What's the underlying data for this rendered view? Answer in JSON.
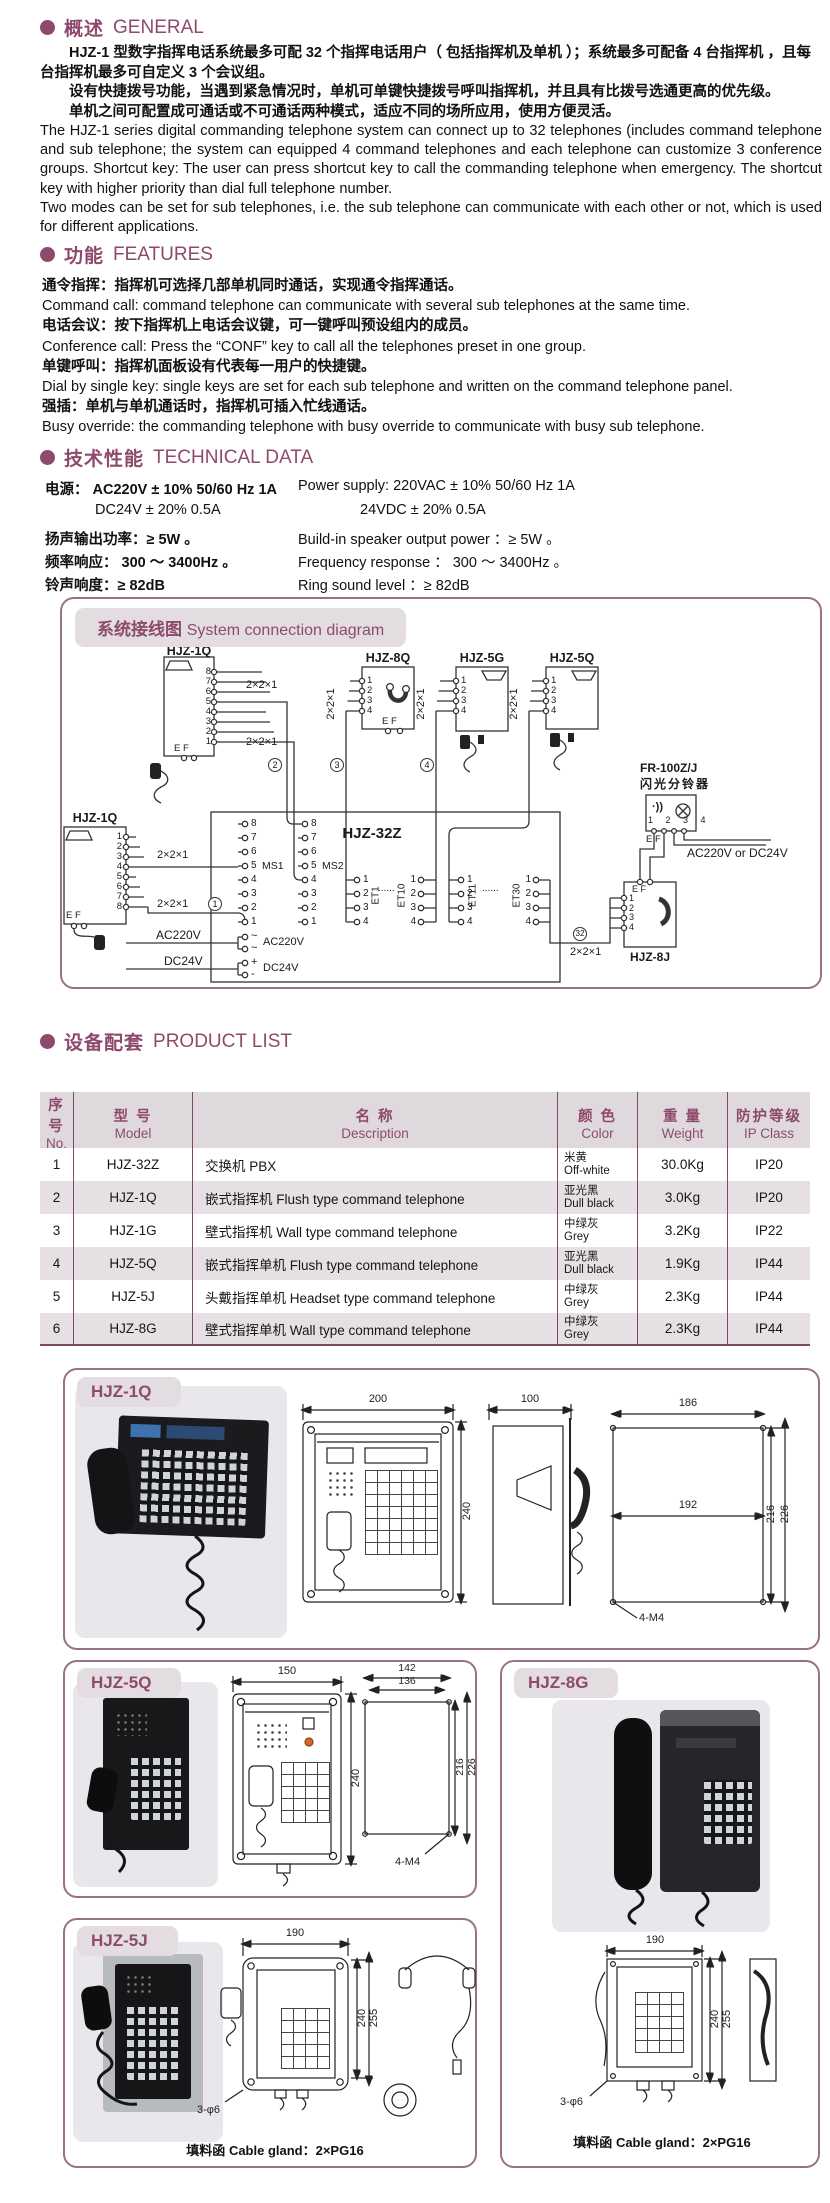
{
  "colors": {
    "accent": "#8e4a6c",
    "table_line": "#7b4a66",
    "chip_bg": "#e3dde1",
    "row_alt": "#e6e0e4",
    "led_orange": "#d06a28"
  },
  "general": {
    "title_cn": "概述",
    "title_en": "GENERAL",
    "cn": [
      "HJZ-1 型数字指挥电话系统最多可配 32 个指挥电话用户（ 包括指挥机及单机 ）；系统最多可配备 4 台指挥机 ，且每台指挥机最多可自定义 3 个会议组。",
      "设有快捷拨号功能，当遇到紧急情况时，单机可单键快捷拨号呼叫指挥机，并且具有比拨号选通更高的优先级。",
      "单机之间可配置成可通话或不可通话两种模式，适应不同的场所应用，使用方便灵活。"
    ],
    "en": "The HJZ-1 series digital commanding telephone system can connect up to 32 telephones (includes command telephone and sub telephone; the system can equipped 4 command telephones and each telephone can customize 3 conference groups. Shortcut key: The user can press shortcut key to call the commanding telephone when emergency. The shortcut key with higher priority than dial full telephone number.\nTwo modes can be set for sub telephones, i.e. the sub telephone can communicate with each other or not, which is used for different applications."
  },
  "features": {
    "title_cn": "功能",
    "title_en": "FEATURES",
    "items": [
      {
        "cn": "通令指挥：指挥机可选择几部单机同时通话，实现通令指挥通话。",
        "en": "Command call: command telephone can communicate with  several sub telephones at the same time."
      },
      {
        "cn": "电话会议：按下指挥机上电话会议键，可一键呼叫预设组内的成员。",
        "en": "Conference call:  Press  the “CONF” key to call all the telephones preset in one group."
      },
      {
        "cn": "单键呼叫：指挥机面板设有代表每一用户的快捷键。",
        "en": "Dial  by single key:  single  keys are set for each sub telephone and written on the command telephone panel."
      },
      {
        "cn": "强插：单机与单机通话时，指挥机可插入忙线通话。",
        "en": "Busy  override:  the commanding telephone with busy override to communicate with busy sub telephone."
      }
    ]
  },
  "technical": {
    "title_cn": "技术性能",
    "title_en": "TECHNICAL  DATA",
    "left": [
      "电源：  AC220V ± 10% 50/60 Hz 1A",
      "DC24V ± 20%    0.5A",
      "扬声输出功率：≥ 5W 。",
      "频率响应：  300 ～ 3400Hz 。",
      "铃声响度：≥ 82dB"
    ],
    "right": [
      "Power supply: 220VAC ± 10% 50/60 Hz 1A",
      "24VDC ± 20%    0.5A",
      "Build-in speaker output power ：≥ 5W 。",
      "Frequency response ：  300 ～ 3400Hz 。",
      "Ring sound level ：≥ 82dB"
    ]
  },
  "diagram": {
    "title_cn": "系统接线图",
    "title_en": "System connection diagram",
    "d_hjz1q": "HJZ-1Q",
    "d_hjz8q": "HJZ-8Q",
    "d_hjz5g": "HJZ-5G",
    "d_hjz5q": "HJZ-5Q",
    "d_hjz32z": "HJZ-32Z",
    "d_hjz8j": "HJZ-8J",
    "d_fr": "FR-100Z/J",
    "d_fr_cn": "闪光分铃器",
    "wire": "2×2×1",
    "ms1": "MS1",
    "ms2": "MS2",
    "et1": "ET1",
    "et10": "ET10",
    "et11": "ET11",
    "et30": "ET30",
    "dots": "......",
    "ac": "AC220V",
    "dc": "DC24V",
    "acdc": "AC220V\nor DC24V",
    "ef": "E F",
    "ef2": "E  F",
    "p81": "8\n7\n6\n5\n4\n3\n2\n1",
    "p18": "1\n2\n3\n4\n5\n6\n7\n8",
    "p14": "1\n2\n3\n4",
    "p14h": "1 2 3 4",
    "tilde": "~\n~",
    "pm": "+\n-",
    "c1": "1",
    "c2": "2",
    "c3": "3",
    "c4": "4",
    "c32": "32"
  },
  "product_list": {
    "title_cn": "设备配套",
    "title_en": "PRODUCT LIST",
    "headers": [
      {
        "cn": "序号",
        "en": "No."
      },
      {
        "cn": "型 号",
        "en": "Model"
      },
      {
        "cn": "名  称",
        "en": "Description"
      },
      {
        "cn": "颜 色",
        "en": "Color"
      },
      {
        "cn": "重 量",
        "en": "Weight"
      },
      {
        "cn": "防护等级",
        "en": "IP Class"
      }
    ],
    "rows": [
      {
        "no": "1",
        "model": "HJZ-32Z",
        "desc": "交换机  PBX",
        "color_cn": "米黄",
        "color_en": "Off-white",
        "weight": "30.0Kg",
        "ip": "IP20"
      },
      {
        "no": "2",
        "model": "HJZ-1Q",
        "desc": "嵌式指挥机  Flush type command telephone",
        "color_cn": "亚光黑",
        "color_en": "Dull black",
        "weight": "3.0Kg",
        "ip": "IP20"
      },
      {
        "no": "3",
        "model": "HJZ-1G",
        "desc": "壁式指挥机  Wall type command telephone",
        "color_cn": "中绿灰",
        "color_en": "Grey",
        "weight": "3.2Kg",
        "ip": "IP22"
      },
      {
        "no": "4",
        "model": "HJZ-5Q",
        "desc": "嵌式指挥单机  Flush type command telephone",
        "color_cn": "亚光黑",
        "color_en": "Dull black",
        "weight": "1.9Kg",
        "ip": "IP44"
      },
      {
        "no": "5",
        "model": "HJZ-5J",
        "desc": "头戴指挥单机  Headset type command telephone",
        "color_cn": "中绿灰",
        "color_en": "Grey",
        "weight": "2.3Kg",
        "ip": "IP44"
      },
      {
        "no": "6",
        "model": "HJZ-8G",
        "desc": "壁式指挥单机  Wall type command telephone",
        "color_cn": "中绿灰",
        "color_en": "Grey",
        "weight": "2.3Kg",
        "ip": "IP44"
      }
    ]
  },
  "boxes": {
    "hjz1q": {
      "title": "HJZ-1Q",
      "dim_w": "200",
      "dim_h": "240",
      "dim_d": "100",
      "cut_w": "186",
      "cut_mid": "192",
      "cut_h1": "216",
      "cut_h2": "226",
      "screw": "4-M4"
    },
    "hjz5q": {
      "title": "HJZ-5Q",
      "dim_w": "150",
      "dim_h": "240",
      "cut_w1": "142",
      "cut_w2": "136",
      "cut_h1": "216",
      "cut_h2": "226",
      "screw": "4-M4"
    },
    "hjz8g": {
      "title": "HJZ-8G",
      "dim_w": "190",
      "dim_h1": "240",
      "dim_h2": "255",
      "holes": "3-φ6",
      "gland_cn": "填料函",
      "gland_en": "Cable gland：2×PG16"
    },
    "hjz5j": {
      "title": "HJZ-5J",
      "dim_w": "190",
      "dim_h1": "240",
      "dim_h2": "255",
      "holes": "3-φ6",
      "gland_cn": "填料函",
      "gland_en": "Cable gland：2×PG16"
    }
  }
}
